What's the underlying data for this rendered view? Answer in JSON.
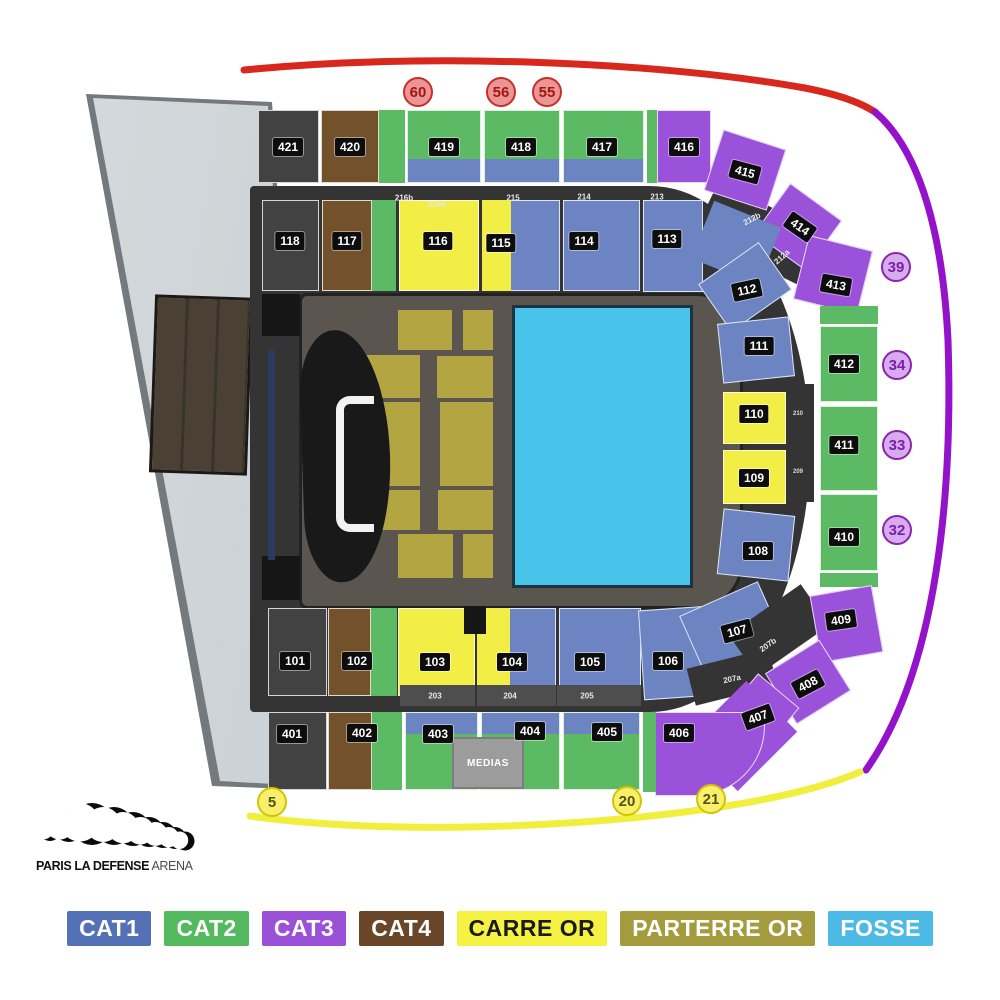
{
  "venue_logo": {
    "bold": "PARIS LA DEFENSE",
    "light": "ARENA"
  },
  "medias_label": "MEDIAS",
  "colors": {
    "cat1": "#6d84c2",
    "cat2": "#5bba63",
    "cat3": "#9b52da",
    "cat4": "#73512b",
    "carre": "#f3ee45",
    "parterre": "#b3a542",
    "fosse": "#48c3ea",
    "dark": "#424242",
    "base": "#343434",
    "black": "#161616",
    "navy": "#2d3a60",
    "gray": "#4e4e4e",
    "arc_red": "#d8281e",
    "arc_purple": "#9412c9",
    "arc_yellow": "#f2ee3e"
  },
  "legend": [
    {
      "label": "CAT1",
      "bg": "#5571b6",
      "fg": "#ffffff"
    },
    {
      "label": "CAT2",
      "bg": "#54b85e",
      "fg": "#ffffff"
    },
    {
      "label": "CAT3",
      "bg": "#9b50d8",
      "fg": "#ffffff"
    },
    {
      "label": "CAT4",
      "bg": "#6a4628",
      "fg": "#ffffff"
    },
    {
      "label": "CARRE OR",
      "bg": "#f5f243",
      "fg": "#1a1a1a"
    },
    {
      "label": "PARTERRE OR",
      "bg": "#a49a3e",
      "fg": "#ffffff"
    },
    {
      "label": "FOSSE",
      "bg": "#4cbae4",
      "fg": "#ffffff"
    }
  ],
  "gates": [
    {
      "g": "red",
      "t": "60",
      "x": 418,
      "y": 92
    },
    {
      "g": "red",
      "t": "56",
      "x": 501,
      "y": 92
    },
    {
      "g": "red",
      "t": "55",
      "x": 547,
      "y": 92
    },
    {
      "g": "purple",
      "t": "39",
      "x": 896,
      "y": 267
    },
    {
      "g": "purple",
      "t": "34",
      "x": 897,
      "y": 365
    },
    {
      "g": "purple",
      "t": "33",
      "x": 897,
      "y": 445
    },
    {
      "g": "purple",
      "t": "32",
      "x": 897,
      "y": 530
    },
    {
      "g": "yellow",
      "t": "5",
      "x": 272,
      "y": 802
    },
    {
      "g": "yellow",
      "t": "20",
      "x": 627,
      "y": 801
    },
    {
      "g": "yellow",
      "t": "21",
      "x": 711,
      "y": 799
    }
  ],
  "map": {
    "rects": [
      {
        "x": 262,
        "y": 294,
        "w": 38,
        "h": 42,
        "c": "black",
        "nb": 1
      },
      {
        "x": 262,
        "y": 556,
        "w": 38,
        "h": 44,
        "c": "black",
        "nb": 1
      },
      {
        "x": 268,
        "y": 350,
        "w": 7,
        "h": 210,
        "c": "navy",
        "nb": 1
      },
      {
        "x": 398,
        "y": 310,
        "w": 54,
        "h": 40,
        "c": "parterre",
        "nb": 1
      },
      {
        "x": 463,
        "y": 310,
        "w": 30,
        "h": 40,
        "c": "parterre",
        "nb": 1
      },
      {
        "x": 365,
        "y": 355,
        "w": 55,
        "h": 43,
        "c": "parterre",
        "nb": 1
      },
      {
        "x": 437,
        "y": 356,
        "w": 56,
        "h": 42,
        "c": "parterre",
        "nb": 1
      },
      {
        "x": 365,
        "y": 402,
        "w": 55,
        "h": 84,
        "c": "parterre",
        "nb": 1
      },
      {
        "x": 440,
        "y": 402,
        "w": 53,
        "h": 84,
        "c": "parterre",
        "nb": 1
      },
      {
        "x": 365,
        "y": 490,
        "w": 55,
        "h": 40,
        "c": "parterre",
        "nb": 1
      },
      {
        "x": 438,
        "y": 490,
        "w": 55,
        "h": 40,
        "c": "parterre",
        "nb": 1
      },
      {
        "x": 398,
        "y": 534,
        "w": 55,
        "h": 44,
        "c": "parterre",
        "nb": 1
      },
      {
        "x": 463,
        "y": 534,
        "w": 30,
        "h": 44,
        "c": "parterre",
        "nb": 1
      },
      {
        "x": 512,
        "y": 305,
        "w": 181,
        "h": 283,
        "c": "fosse",
        "cls": "fosse-rect",
        "nb": 1
      },
      {
        "x": 700,
        "y": 205,
        "w": 120,
        "h": 58,
        "c": "base",
        "r": 26,
        "nb": 1
      },
      {
        "x": 258,
        "y": 110,
        "w": 61,
        "h": 73,
        "c": "dark"
      },
      {
        "x": 321,
        "y": 110,
        "w": 58,
        "h": 73,
        "c": "cat4"
      },
      {
        "x": 379,
        "y": 110,
        "w": 26,
        "h": 73,
        "c": "cat2",
        "nb": 1
      },
      {
        "x": 407,
        "y": 110,
        "w": 74,
        "h": 73,
        "c": "cat2"
      },
      {
        "x": 408,
        "y": 159,
        "w": 72,
        "h": 23,
        "c": "cat1",
        "nb": 1
      },
      {
        "x": 484,
        "y": 110,
        "w": 76,
        "h": 73,
        "c": "cat2"
      },
      {
        "x": 485,
        "y": 159,
        "w": 74,
        "h": 23,
        "c": "cat1",
        "nb": 1
      },
      {
        "x": 563,
        "y": 110,
        "w": 81,
        "h": 73,
        "c": "cat2"
      },
      {
        "x": 564,
        "y": 159,
        "w": 79,
        "h": 23,
        "c": "cat1",
        "nb": 1
      },
      {
        "x": 647,
        "y": 110,
        "w": 11,
        "h": 73,
        "c": "cat2",
        "nb": 1
      },
      {
        "x": 657,
        "y": 110,
        "w": 54,
        "h": 73,
        "c": "cat3"
      },
      {
        "x": 712,
        "y": 138,
        "w": 66,
        "h": 64,
        "c": "cat3",
        "r": 18
      },
      {
        "x": 766,
        "y": 196,
        "w": 64,
        "h": 62,
        "c": "cat3",
        "r": 36
      },
      {
        "x": 800,
        "y": 242,
        "w": 66,
        "h": 66,
        "c": "cat3",
        "r": 14
      },
      {
        "x": 262,
        "y": 200,
        "w": 57,
        "h": 91,
        "c": "dark"
      },
      {
        "x": 322,
        "y": 200,
        "w": 50,
        "h": 91,
        "c": "cat4"
      },
      {
        "x": 372,
        "y": 200,
        "w": 24,
        "h": 91,
        "c": "cat2",
        "nb": 1
      },
      {
        "x": 399,
        "y": 200,
        "w": 80,
        "h": 91,
        "c": "carre"
      },
      {
        "x": 482,
        "y": 200,
        "w": 78,
        "h": 91,
        "c": "cat1"
      },
      {
        "x": 482,
        "y": 200,
        "w": 29,
        "h": 91,
        "c": "carre",
        "nb": 1
      },
      {
        "x": 563,
        "y": 200,
        "w": 77,
        "h": 91,
        "c": "cat1"
      },
      {
        "x": 643,
        "y": 200,
        "w": 60,
        "h": 92,
        "c": "cat1"
      },
      {
        "x": 700,
        "y": 212,
        "w": 72,
        "h": 62,
        "c": "cat1",
        "r": 22,
        "nb": 1
      },
      {
        "x": 708,
        "y": 258,
        "w": 74,
        "h": 58,
        "c": "cat1",
        "r": -35
      },
      {
        "x": 788,
        "y": 384,
        "w": 26,
        "h": 118,
        "c": "base",
        "nb": 1
      },
      {
        "x": 720,
        "y": 320,
        "w": 72,
        "h": 60,
        "c": "cat1",
        "r": -6
      },
      {
        "x": 723,
        "y": 392,
        "w": 63,
        "h": 52,
        "c": "carre"
      },
      {
        "x": 723,
        "y": 450,
        "w": 63,
        "h": 54,
        "c": "carre"
      },
      {
        "x": 720,
        "y": 512,
        "w": 72,
        "h": 66,
        "c": "cat1",
        "r": 6
      },
      {
        "x": 820,
        "y": 306,
        "w": 58,
        "h": 18,
        "c": "cat2",
        "nb": 1
      },
      {
        "x": 820,
        "y": 326,
        "w": 58,
        "h": 76,
        "c": "cat2"
      },
      {
        "x": 820,
        "y": 406,
        "w": 58,
        "h": 85,
        "c": "cat2"
      },
      {
        "x": 820,
        "y": 494,
        "w": 58,
        "h": 77,
        "c": "cat2"
      },
      {
        "x": 820,
        "y": 573,
        "w": 58,
        "h": 14,
        "c": "cat2",
        "nb": 1
      },
      {
        "x": 268,
        "y": 608,
        "w": 59,
        "h": 88,
        "c": "dark"
      },
      {
        "x": 328,
        "y": 608,
        "w": 43,
        "h": 88,
        "c": "cat4"
      },
      {
        "x": 371,
        "y": 608,
        "w": 26,
        "h": 88,
        "c": "cat2",
        "nb": 1
      },
      {
        "x": 398,
        "y": 608,
        "w": 77,
        "h": 88,
        "c": "carre"
      },
      {
        "x": 477,
        "y": 608,
        "w": 79,
        "h": 88,
        "c": "cat1"
      },
      {
        "x": 477,
        "y": 608,
        "w": 33,
        "h": 88,
        "c": "carre",
        "nb": 1
      },
      {
        "x": 559,
        "y": 608,
        "w": 82,
        "h": 88,
        "c": "cat1"
      },
      {
        "x": 641,
        "y": 608,
        "w": 70,
        "h": 90,
        "c": "cat1",
        "r": -4
      },
      {
        "x": 688,
        "y": 596,
        "w": 86,
        "h": 62,
        "c": "cat1",
        "r": -24
      },
      {
        "x": 464,
        "y": 606,
        "w": 22,
        "h": 28,
        "c": "black",
        "nb": 1
      },
      {
        "x": 400,
        "y": 685,
        "w": 75,
        "h": 21,
        "c": "gray",
        "nb": 1
      },
      {
        "x": 477,
        "y": 685,
        "w": 79,
        "h": 21,
        "c": "gray",
        "nb": 1
      },
      {
        "x": 557,
        "y": 685,
        "w": 84,
        "h": 21,
        "c": "gray",
        "nb": 1
      },
      {
        "x": 735,
        "y": 605,
        "w": 88,
        "h": 50,
        "c": "base",
        "r": -35,
        "nb": 1
      },
      {
        "x": 690,
        "y": 658,
        "w": 84,
        "h": 38,
        "c": "base",
        "r": -14,
        "nb": 1
      },
      {
        "x": 815,
        "y": 590,
        "w": 63,
        "h": 68,
        "c": "cat3",
        "r": -10
      },
      {
        "x": 776,
        "y": 652,
        "w": 64,
        "h": 60,
        "c": "cat3",
        "r": -32
      },
      {
        "x": 718,
        "y": 692,
        "w": 74,
        "h": 54,
        "c": "cat3",
        "r": -50
      },
      {
        "x": 700,
        "y": 700,
        "w": 84,
        "h": 72,
        "c": "cat3",
        "r": -45,
        "nb": 1
      },
      {
        "x": 655,
        "y": 712,
        "w": 110,
        "h": 84,
        "c": "cat3",
        "rx": "0 0 70px 0"
      },
      {
        "x": 643,
        "y": 712,
        "w": 13,
        "h": 80,
        "c": "cat2",
        "nb": 1
      },
      {
        "x": 268,
        "y": 712,
        "w": 59,
        "h": 78,
        "c": "dark"
      },
      {
        "x": 328,
        "y": 712,
        "w": 44,
        "h": 78,
        "c": "cat4"
      },
      {
        "x": 372,
        "y": 712,
        "w": 30,
        "h": 78,
        "c": "cat2",
        "nb": 1
      },
      {
        "x": 405,
        "y": 712,
        "w": 73,
        "h": 78,
        "c": "cat2"
      },
      {
        "x": 406,
        "y": 713,
        "w": 71,
        "h": 21,
        "c": "cat1",
        "nb": 1
      },
      {
        "x": 481,
        "y": 712,
        "w": 79,
        "h": 78,
        "c": "cat2"
      },
      {
        "x": 482,
        "y": 713,
        "w": 77,
        "h": 21,
        "c": "cat1",
        "nb": 1
      },
      {
        "x": 563,
        "y": 712,
        "w": 77,
        "h": 78,
        "c": "cat2"
      },
      {
        "x": 564,
        "y": 713,
        "w": 75,
        "h": 21,
        "c": "cat1",
        "nb": 1
      }
    ],
    "chips": [
      {
        "t": "421",
        "x": 288,
        "y": 147
      },
      {
        "t": "420",
        "x": 350,
        "y": 147
      },
      {
        "t": "419",
        "x": 444,
        "y": 147
      },
      {
        "t": "418",
        "x": 521,
        "y": 147
      },
      {
        "t": "417",
        "x": 602,
        "y": 147
      },
      {
        "t": "416",
        "x": 684,
        "y": 147
      },
      {
        "t": "415",
        "x": 745,
        "y": 172,
        "r": 15
      },
      {
        "t": "414",
        "x": 800,
        "y": 227,
        "r": 35
      },
      {
        "t": "413",
        "x": 836,
        "y": 285,
        "r": 10
      },
      {
        "t": "118",
        "x": 290,
        "y": 241
      },
      {
        "t": "117",
        "x": 347,
        "y": 241
      },
      {
        "t": "116",
        "x": 438,
        "y": 241
      },
      {
        "t": "115",
        "x": 501,
        "y": 243
      },
      {
        "t": "114",
        "x": 584,
        "y": 241
      },
      {
        "t": "113",
        "x": 667,
        "y": 239
      },
      {
        "t": "112",
        "x": 747,
        "y": 290,
        "r": -12
      },
      {
        "t": "111",
        "x": 759,
        "y": 346
      },
      {
        "t": "110",
        "x": 754,
        "y": 414
      },
      {
        "t": "109",
        "x": 754,
        "y": 478
      },
      {
        "t": "108",
        "x": 758,
        "y": 551
      },
      {
        "t": "107",
        "x": 737,
        "y": 631,
        "r": -15
      },
      {
        "t": "412",
        "x": 844,
        "y": 364
      },
      {
        "t": "411",
        "x": 844,
        "y": 445
      },
      {
        "t": "410",
        "x": 844,
        "y": 537
      },
      {
        "t": "409",
        "x": 841,
        "y": 620,
        "r": -8
      },
      {
        "t": "408",
        "x": 808,
        "y": 684,
        "r": -28
      },
      {
        "t": "407",
        "x": 758,
        "y": 717,
        "r": -20
      },
      {
        "t": "101",
        "x": 295,
        "y": 661
      },
      {
        "t": "102",
        "x": 357,
        "y": 661
      },
      {
        "t": "103",
        "x": 435,
        "y": 662
      },
      {
        "t": "104",
        "x": 512,
        "y": 662
      },
      {
        "t": "105",
        "x": 590,
        "y": 662
      },
      {
        "t": "106",
        "x": 668,
        "y": 661
      },
      {
        "t": "401",
        "x": 292,
        "y": 734
      },
      {
        "t": "402",
        "x": 362,
        "y": 733
      },
      {
        "t": "403",
        "x": 438,
        "y": 734
      },
      {
        "t": "404",
        "x": 530,
        "y": 731
      },
      {
        "t": "405",
        "x": 607,
        "y": 732
      },
      {
        "t": "406",
        "x": 679,
        "y": 733
      },
      {
        "t": "216b",
        "x": 404,
        "y": 198,
        "s": "sm"
      },
      {
        "t": "216a",
        "x": 437,
        "y": 204,
        "s": "sm"
      },
      {
        "t": "215",
        "x": 513,
        "y": 198,
        "s": "sm"
      },
      {
        "t": "214",
        "x": 584,
        "y": 197,
        "s": "sm"
      },
      {
        "t": "213",
        "x": 657,
        "y": 197,
        "s": "sm"
      },
      {
        "t": "212b",
        "x": 752,
        "y": 219,
        "r": -28,
        "s": "sm"
      },
      {
        "t": "212a",
        "x": 782,
        "y": 257,
        "r": -42,
        "s": "sm"
      },
      {
        "t": "210",
        "x": 798,
        "y": 414,
        "s": "xs"
      },
      {
        "t": "209",
        "x": 798,
        "y": 472,
        "s": "xs"
      },
      {
        "t": "207b",
        "x": 768,
        "y": 645,
        "r": -35,
        "s": "sm"
      },
      {
        "t": "207a",
        "x": 732,
        "y": 679,
        "r": -12,
        "s": "sm"
      },
      {
        "t": "203",
        "x": 435,
        "y": 696,
        "s": "sm"
      },
      {
        "t": "204",
        "x": 510,
        "y": 696,
        "s": "sm"
      },
      {
        "t": "205",
        "x": 587,
        "y": 696,
        "s": "sm"
      }
    ]
  }
}
